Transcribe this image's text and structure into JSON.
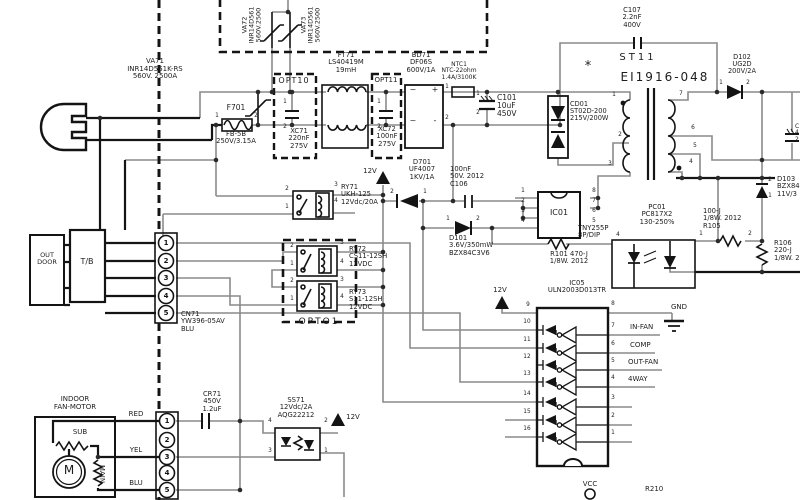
{
  "diagram": {
    "type": "circuit-schematic"
  },
  "colors": {
    "background": "#ffffff",
    "wire_gray": "#8a8a8a",
    "line_black": "#141414",
    "text": "#1c1c1c"
  },
  "labels": [
    {
      "n": "va72-label",
      "t": "VA72\nINR14D561\n560V.2500",
      "x": 252,
      "y": 25,
      "s": 6.5,
      "r": -90
    },
    {
      "n": "va73-label",
      "t": "VA73\nINR14D561\n560V.2500",
      "x": 311,
      "y": 25,
      "s": 6.5,
      "r": -90
    },
    {
      "n": "va71-label",
      "t": "VA71\nINR14D561K-RS\n560V. 2500A",
      "x": 155,
      "y": 58,
      "s": 7
    },
    {
      "n": "f701-label",
      "t": "F701",
      "x": 236,
      "y": 104,
      "s": 7.5
    },
    {
      "n": "f701-value",
      "t": "FB-5B\n250V/3.15A",
      "x": 236,
      "y": 131,
      "s": 6.8
    },
    {
      "n": "opt10-label",
      "t": "OPT10",
      "x": 294,
      "y": 77,
      "s": 8,
      "ls": 1
    },
    {
      "n": "xc71-label",
      "t": "XC71\n220nF\n275V",
      "x": 299,
      "y": 128,
      "s": 6.8
    },
    {
      "n": "ft71-label",
      "t": "FT71\nLS40419M\n19mH",
      "x": 346,
      "y": 52,
      "s": 6.8
    },
    {
      "n": "opt11-label",
      "t": "OPT11",
      "x": 386,
      "y": 77,
      "s": 7
    },
    {
      "n": "xc72-label",
      "t": "XC72\n100nF\n275V",
      "x": 387,
      "y": 126,
      "s": 6.8
    },
    {
      "n": "bd71-label",
      "t": "BD71\nDF06S\n600V/1A",
      "x": 421,
      "y": 52,
      "s": 6.8
    },
    {
      "n": "ntc1-label",
      "t": "NTC1\nNTC-22ohm\n1.4A/3100K",
      "x": 459,
      "y": 62,
      "s": 6
    },
    {
      "n": "c101-label",
      "t": "C101\n10uF\n450V",
      "x": 497,
      "y": 94,
      "s": 7.5,
      "a": "l"
    },
    {
      "n": "d701-label",
      "t": "D701\nUF4007\n1KV/1A",
      "x": 422,
      "y": 159,
      "s": 6.8
    },
    {
      "n": "c106-label",
      "t": "100nF\n50V. 2012\nC106",
      "x": 450,
      "y": 166,
      "s": 6.8,
      "a": "l"
    },
    {
      "n": "d101-label",
      "t": "D101\n3.6V/350mW\nBZX84C3V6",
      "x": 449,
      "y": 235,
      "s": 6.8,
      "a": "l"
    },
    {
      "n": "c107-label",
      "t": "C107\n2.2nF\n400V",
      "x": 632,
      "y": 7,
      "s": 6.8
    },
    {
      "n": "st11-label",
      "t": "ST11",
      "x": 638,
      "y": 53,
      "s": 10,
      "ls": 3
    },
    {
      "n": "st11-core",
      "t": "EI1916-048",
      "x": 665,
      "y": 71,
      "s": 12,
      "ls": 2
    },
    {
      "n": "polarity-star",
      "t": "*",
      "x": 588,
      "y": 60,
      "s": 13
    },
    {
      "n": "cd01-label",
      "t": "CD01\nST02D-200\n215V/200W",
      "x": 570,
      "y": 101,
      "s": 6.6,
      "a": "l"
    },
    {
      "n": "d102-label",
      "t": "D102\nUG2D\n200V/2A",
      "x": 742,
      "y": 54,
      "s": 6.6
    },
    {
      "n": "ic01-name",
      "t": "IC01",
      "x": 559,
      "y": 209,
      "s": 8
    },
    {
      "n": "ic01-part",
      "t": "TNY255P\n8P/DIP",
      "x": 578,
      "y": 225,
      "s": 6.8,
      "a": "l"
    },
    {
      "n": "r101-label",
      "t": "R101 470-J\n1/8W. 2012",
      "x": 569,
      "y": 251,
      "s": 6.8
    },
    {
      "n": "pc01-label",
      "t": "PC01\nPC817X2\n130-250%",
      "x": 657,
      "y": 204,
      "s": 6.8
    },
    {
      "n": "r105-label",
      "t": "100-J\n1/8W. 2012\nR105",
      "x": 703,
      "y": 208,
      "s": 6.8,
      "a": "l"
    },
    {
      "n": "d103-label",
      "t": "D103\nBZX84\n11V/3",
      "x": 777,
      "y": 176,
      "s": 6.8,
      "a": "l"
    },
    {
      "n": "r106-label",
      "t": "R106\n220-J\n1/8W. 2",
      "x": 774,
      "y": 240,
      "s": 6.8,
      "a": "l"
    },
    {
      "n": "ry71-label",
      "t": "RY71\nUKH-125\n12Vdc/20A",
      "x": 341,
      "y": 184,
      "s": 6.8,
      "a": "l"
    },
    {
      "n": "ry72-label",
      "t": "RY72\nCS11-12SH\n12VDC",
      "x": 349,
      "y": 246,
      "s": 6.8,
      "a": "l"
    },
    {
      "n": "ry73-label",
      "t": "RY73\nS11-12SH\n12VDC",
      "x": 349,
      "y": 289,
      "s": 6.8,
      "a": "l"
    },
    {
      "n": "opto1-label",
      "t": "OPTO1",
      "x": 319,
      "y": 318,
      "s": 9,
      "ls": 2
    },
    {
      "n": "outdoor-label",
      "t": "OUT\nDOOR",
      "x": 47,
      "y": 252,
      "s": 6.5
    },
    {
      "n": "tb-label",
      "t": "T/B",
      "x": 87,
      "y": 258,
      "s": 8
    },
    {
      "n": "cn71-label",
      "t": "CN71\nYW396-05AV\n BLU",
      "x": 181,
      "y": 311,
      "s": 6.8,
      "a": "l"
    },
    {
      "n": "indoor-fan-label",
      "t": "INDOOR\nFAN-MOTOR",
      "x": 75,
      "y": 396,
      "s": 7
    },
    {
      "n": "sub-winding-label",
      "t": "SUB",
      "x": 80,
      "y": 429,
      "s": 7
    },
    {
      "n": "main-winding-label",
      "t": "MAIN",
      "x": 101,
      "y": 474,
      "s": 7,
      "r": 90
    },
    {
      "n": "motor-m",
      "t": "M",
      "x": 69,
      "y": 464,
      "s": 12
    },
    {
      "n": "wire-red-label",
      "t": "RED",
      "x": 136,
      "y": 411,
      "s": 7
    },
    {
      "n": "wire-yel-label",
      "t": "YEL",
      "x": 136,
      "y": 447,
      "s": 7
    },
    {
      "n": "wire-blu-label",
      "t": "BLU",
      "x": 136,
      "y": 480,
      "s": 7
    },
    {
      "n": "cr71-label",
      "t": "CR71\n450V\n1.2uF",
      "x": 212,
      "y": 391,
      "s": 6.8
    },
    {
      "n": "ss71-label",
      "t": "SS71\n12Vdc/2A\nAQG22212",
      "x": 296,
      "y": 397,
      "s": 6.8
    },
    {
      "n": "rail-12v-a",
      "t": "12V",
      "x": 370,
      "y": 168,
      "s": 7
    },
    {
      "n": "rail-12v-b",
      "t": "12V",
      "x": 500,
      "y": 287,
      "s": 7
    },
    {
      "n": "rail-12v-c",
      "t": "12V",
      "x": 353,
      "y": 414,
      "s": 7
    },
    {
      "n": "ic05-label",
      "t": "IC05\nULN2003D013TR",
      "x": 577,
      "y": 280,
      "s": 6.8
    },
    {
      "n": "gnd-label",
      "t": "GND",
      "x": 679,
      "y": 304,
      "s": 7
    },
    {
      "n": "out-in-fan",
      "t": "IN-FAN",
      "x": 630,
      "y": 324,
      "s": 7,
      "a": "l"
    },
    {
      "n": "out-comp",
      "t": "COMP",
      "x": 630,
      "y": 342,
      "s": 7,
      "a": "l"
    },
    {
      "n": "out-out-fan",
      "t": "OUT-FAN",
      "x": 628,
      "y": 359,
      "s": 7,
      "a": "l"
    },
    {
      "n": "out-4way",
      "t": "4WAY",
      "x": 628,
      "y": 376,
      "s": 7,
      "a": "l"
    },
    {
      "n": "vcc-label",
      "t": "VCC",
      "x": 590,
      "y": 481,
      "s": 7
    },
    {
      "n": "r210-label",
      "t": "R210",
      "x": 645,
      "y": 486,
      "s": 7,
      "a": "l"
    },
    {
      "n": "edge-cap-label-cut",
      "t": "C\n4\n2",
      "x": 795,
      "y": 124,
      "s": 6,
      "a": "l"
    },
    {
      "n": "bd71-ac1",
      "t": "~",
      "x": 413,
      "y": 86,
      "s": 8
    },
    {
      "n": "bd71-plus",
      "t": "+",
      "x": 435,
      "y": 86,
      "s": 8
    },
    {
      "n": "bd71-ac2",
      "t": "~",
      "x": 413,
      "y": 117,
      "s": 8
    },
    {
      "n": "bd71-minus",
      "t": "-",
      "x": 435,
      "y": 117,
      "s": 8
    }
  ],
  "pins": [
    {
      "t": "1",
      "x": 217,
      "y": 116
    },
    {
      "t": "2",
      "x": 256,
      "y": 116
    },
    {
      "t": "1",
      "x": 285,
      "y": 102
    },
    {
      "t": "2",
      "x": 285,
      "y": 127
    },
    {
      "t": "1",
      "x": 379,
      "y": 102
    },
    {
      "t": "2",
      "x": 379,
      "y": 127
    },
    {
      "t": "1",
      "x": 447,
      "y": 87
    },
    {
      "t": "2",
      "x": 447,
      "y": 118
    },
    {
      "t": "1",
      "x": 478,
      "y": 94
    },
    {
      "t": "2",
      "x": 478,
      "y": 113
    },
    {
      "t": "2",
      "x": 392,
      "y": 192
    },
    {
      "t": "1",
      "x": 425,
      "y": 192
    },
    {
      "t": "1",
      "x": 448,
      "y": 219
    },
    {
      "t": "2",
      "x": 478,
      "y": 219
    },
    {
      "t": "1",
      "x": 523,
      "y": 191
    },
    {
      "t": "2",
      "x": 523,
      "y": 201
    },
    {
      "t": "3",
      "x": 523,
      "y": 211
    },
    {
      "t": "4",
      "x": 523,
      "y": 221
    },
    {
      "t": "8",
      "x": 594,
      "y": 191
    },
    {
      "t": "7",
      "x": 594,
      "y": 201
    },
    {
      "t": "6",
      "x": 594,
      "y": 211
    },
    {
      "t": "5",
      "x": 594,
      "y": 221
    },
    {
      "t": "1",
      "x": 614,
      "y": 95
    },
    {
      "t": "2",
      "x": 620,
      "y": 135
    },
    {
      "t": "3",
      "x": 610,
      "y": 164
    },
    {
      "t": "7",
      "x": 681,
      "y": 94
    },
    {
      "t": "6",
      "x": 693,
      "y": 128
    },
    {
      "t": "5",
      "x": 695,
      "y": 146
    },
    {
      "t": "4",
      "x": 691,
      "y": 162
    },
    {
      "t": "1",
      "x": 721,
      "y": 83
    },
    {
      "t": "2",
      "x": 748,
      "y": 83
    },
    {
      "t": "2",
      "x": 770,
      "y": 180
    },
    {
      "t": "1",
      "x": 770,
      "y": 196
    },
    {
      "t": "1",
      "x": 701,
      "y": 234
    },
    {
      "t": "2",
      "x": 750,
      "y": 234
    },
    {
      "t": "4",
      "x": 618,
      "y": 235
    },
    {
      "t": "2",
      "x": 287,
      "y": 189
    },
    {
      "t": "1",
      "x": 287,
      "y": 207
    },
    {
      "t": "3",
      "x": 336,
      "y": 185
    },
    {
      "t": "4",
      "x": 336,
      "y": 201
    },
    {
      "t": "2",
      "x": 292,
      "y": 246
    },
    {
      "t": "1",
      "x": 292,
      "y": 264
    },
    {
      "t": "3",
      "x": 342,
      "y": 243
    },
    {
      "t": "4",
      "x": 342,
      "y": 262
    },
    {
      "t": "2",
      "x": 292,
      "y": 281
    },
    {
      "t": "1",
      "x": 292,
      "y": 299
    },
    {
      "t": "3",
      "x": 342,
      "y": 280
    },
    {
      "t": "4",
      "x": 342,
      "y": 297
    },
    {
      "t": "4",
      "x": 270,
      "y": 421
    },
    {
      "t": "2",
      "x": 326,
      "y": 421
    },
    {
      "t": "3",
      "x": 270,
      "y": 451
    },
    {
      "t": "1",
      "x": 326,
      "y": 451
    },
    {
      "t": "9",
      "x": 528,
      "y": 305
    },
    {
      "t": "10",
      "x": 527,
      "y": 322
    },
    {
      "t": "11",
      "x": 527,
      "y": 340
    },
    {
      "t": "12",
      "x": 527,
      "y": 357
    },
    {
      "t": "13",
      "x": 527,
      "y": 374
    },
    {
      "t": "14",
      "x": 527,
      "y": 394
    },
    {
      "t": "15",
      "x": 527,
      "y": 412
    },
    {
      "t": "16",
      "x": 527,
      "y": 429
    },
    {
      "t": "8",
      "x": 613,
      "y": 304
    },
    {
      "t": "7",
      "x": 613,
      "y": 326
    },
    {
      "t": "6",
      "x": 613,
      "y": 344
    },
    {
      "t": "5",
      "x": 613,
      "y": 361
    },
    {
      "t": "4",
      "x": 613,
      "y": 378
    },
    {
      "t": "3",
      "x": 613,
      "y": 398
    },
    {
      "t": "2",
      "x": 613,
      "y": 416
    },
    {
      "t": "1",
      "x": 613,
      "y": 433
    }
  ],
  "connectors": {
    "top": {
      "name": "cn71-connector",
      "pins": [
        "1",
        "2",
        "3",
        "4",
        "5"
      ],
      "cx": 166,
      "ys": [
        243,
        261,
        278,
        296,
        313
      ]
    },
    "bottom": {
      "name": "fan-motor-connector",
      "pins": [
        "1",
        "2",
        "3",
        "4",
        "5"
      ],
      "cx": 167,
      "ys": [
        421,
        440,
        457,
        473,
        490
      ]
    }
  }
}
